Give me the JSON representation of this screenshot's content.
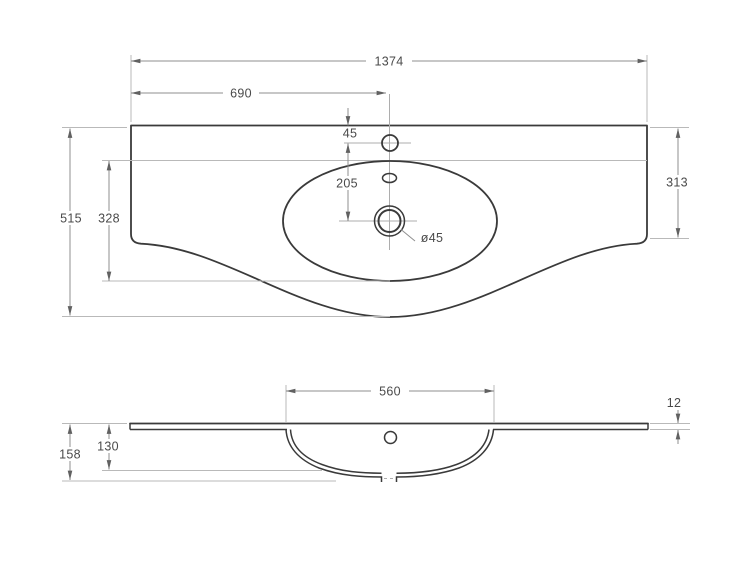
{
  "colors": {
    "background": "#ffffff",
    "outline": "#3a3a3a",
    "dimension_line": "#8f8f8f",
    "extension_line": "#b9b9b9",
    "text": "#4a4a4a"
  },
  "top_view": {
    "dimensions": {
      "overall_width": "1374",
      "left_to_faucet": "690",
      "edge_to_faucet": "45",
      "faucet_to_drain": "205",
      "total_depth": "515",
      "basin_depth": "328",
      "side_depth": "313",
      "drain_diameter": "ø45"
    }
  },
  "front_view": {
    "dimensions": {
      "bowl_width": "560",
      "top_thickness": "12",
      "total_height": "158",
      "bowl_depth": "130"
    }
  }
}
